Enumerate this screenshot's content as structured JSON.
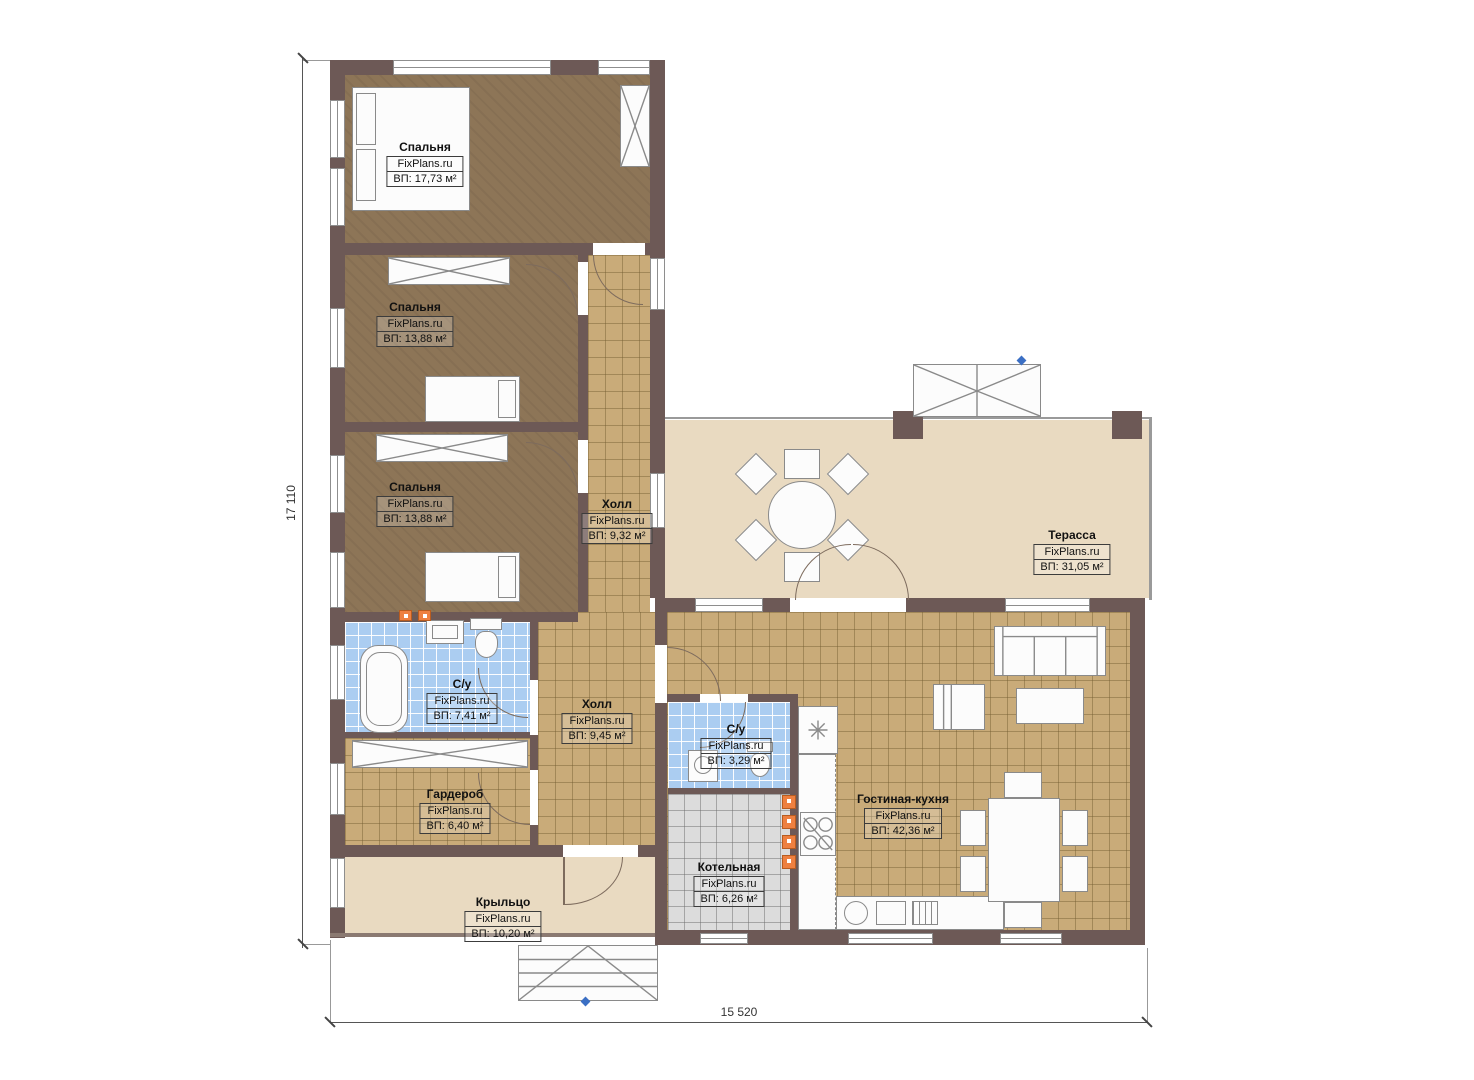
{
  "branding": "FixPlans.ru",
  "dimensions": {
    "vertical": "17 110",
    "horizontal": "15 520"
  },
  "rooms": [
    {
      "id": "bedroom-1",
      "name": "Спальня",
      "area": "ВП: 17,73 м²"
    },
    {
      "id": "bedroom-2",
      "name": "Спальня",
      "area": "ВП: 13,88 м²"
    },
    {
      "id": "bedroom-3",
      "name": "Спальня",
      "area": "ВП: 13,88 м²"
    },
    {
      "id": "hall-1",
      "name": "Холл",
      "area": "ВП: 9,32 м²"
    },
    {
      "id": "terrace",
      "name": "Терасса",
      "area": "ВП: 31,05 м²"
    },
    {
      "id": "bathroom-1",
      "name": "С/у",
      "area": "ВП: 7,41 м²"
    },
    {
      "id": "hall-2",
      "name": "Холл",
      "area": "ВП: 9,45 м²"
    },
    {
      "id": "bathroom-2",
      "name": "С/у",
      "area": "ВП: 3,29 м²"
    },
    {
      "id": "wardrobe",
      "name": "Гардероб",
      "area": "ВП: 6,40 м²"
    },
    {
      "id": "living-kitchen",
      "name": "Гостиная-кухня",
      "area": "ВП: 42,36 м²"
    },
    {
      "id": "boiler-room",
      "name": "Котельная",
      "area": "ВП: 6,26 м²"
    },
    {
      "id": "porch",
      "name": "Крыльцо",
      "area": "ВП: 10,20 м²"
    }
  ],
  "colors": {
    "wall": "#6d5956",
    "bedroom_floor": "#8d7557",
    "tile_floor": "#c9ab79",
    "terrace_floor": "#e9dac1",
    "bathroom_tile": "#abcdf1",
    "boiler_tile": "#dcdcdc",
    "accent_orange": "#ee8040",
    "marker_blue": "#3b6fc4"
  }
}
